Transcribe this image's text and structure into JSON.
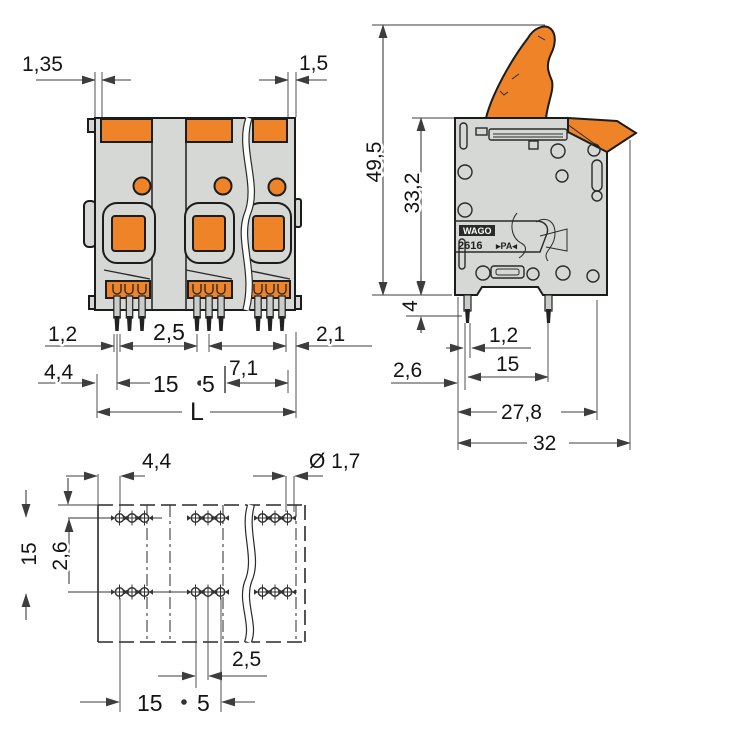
{
  "colors": {
    "accent_orange": "#ee8427",
    "body_gray": "#d6d8d5",
    "outline_ink": "#1c1c1c",
    "dim_line": "#3d3d3d",
    "pin_dark": "#222222"
  },
  "views": {
    "front": {
      "dims": {
        "lip_left": "1,35",
        "lip_right": "1,5",
        "pin_width": "1,2",
        "pin_pitch": "2,5",
        "right_offset": "2,1",
        "edge_to_pin": "4,4",
        "pole_pitch": "15",
        "pin_group": "5",
        "group_width": "7,1",
        "total_length": "L"
      }
    },
    "side": {
      "marking": {
        "brand": "WAGO",
        "series": "2616",
        "material": "▸PA◂"
      },
      "dims": {
        "total_height": "49,5",
        "body_height": "33,2",
        "pin_length": "4",
        "pin_width": "1,2",
        "pin_spacing": "15",
        "edge_offset": "2,6",
        "body_depth": "27,8",
        "total_depth": "32"
      }
    },
    "bottom": {
      "dims": {
        "edge_to_hole": "4,4",
        "hole_diameter": "Ø 1,7",
        "row_spacing": "15",
        "row_offset": "2,6",
        "hole_pitch": "2,5",
        "pole_pitch": "15",
        "pin_group": "5"
      }
    }
  }
}
